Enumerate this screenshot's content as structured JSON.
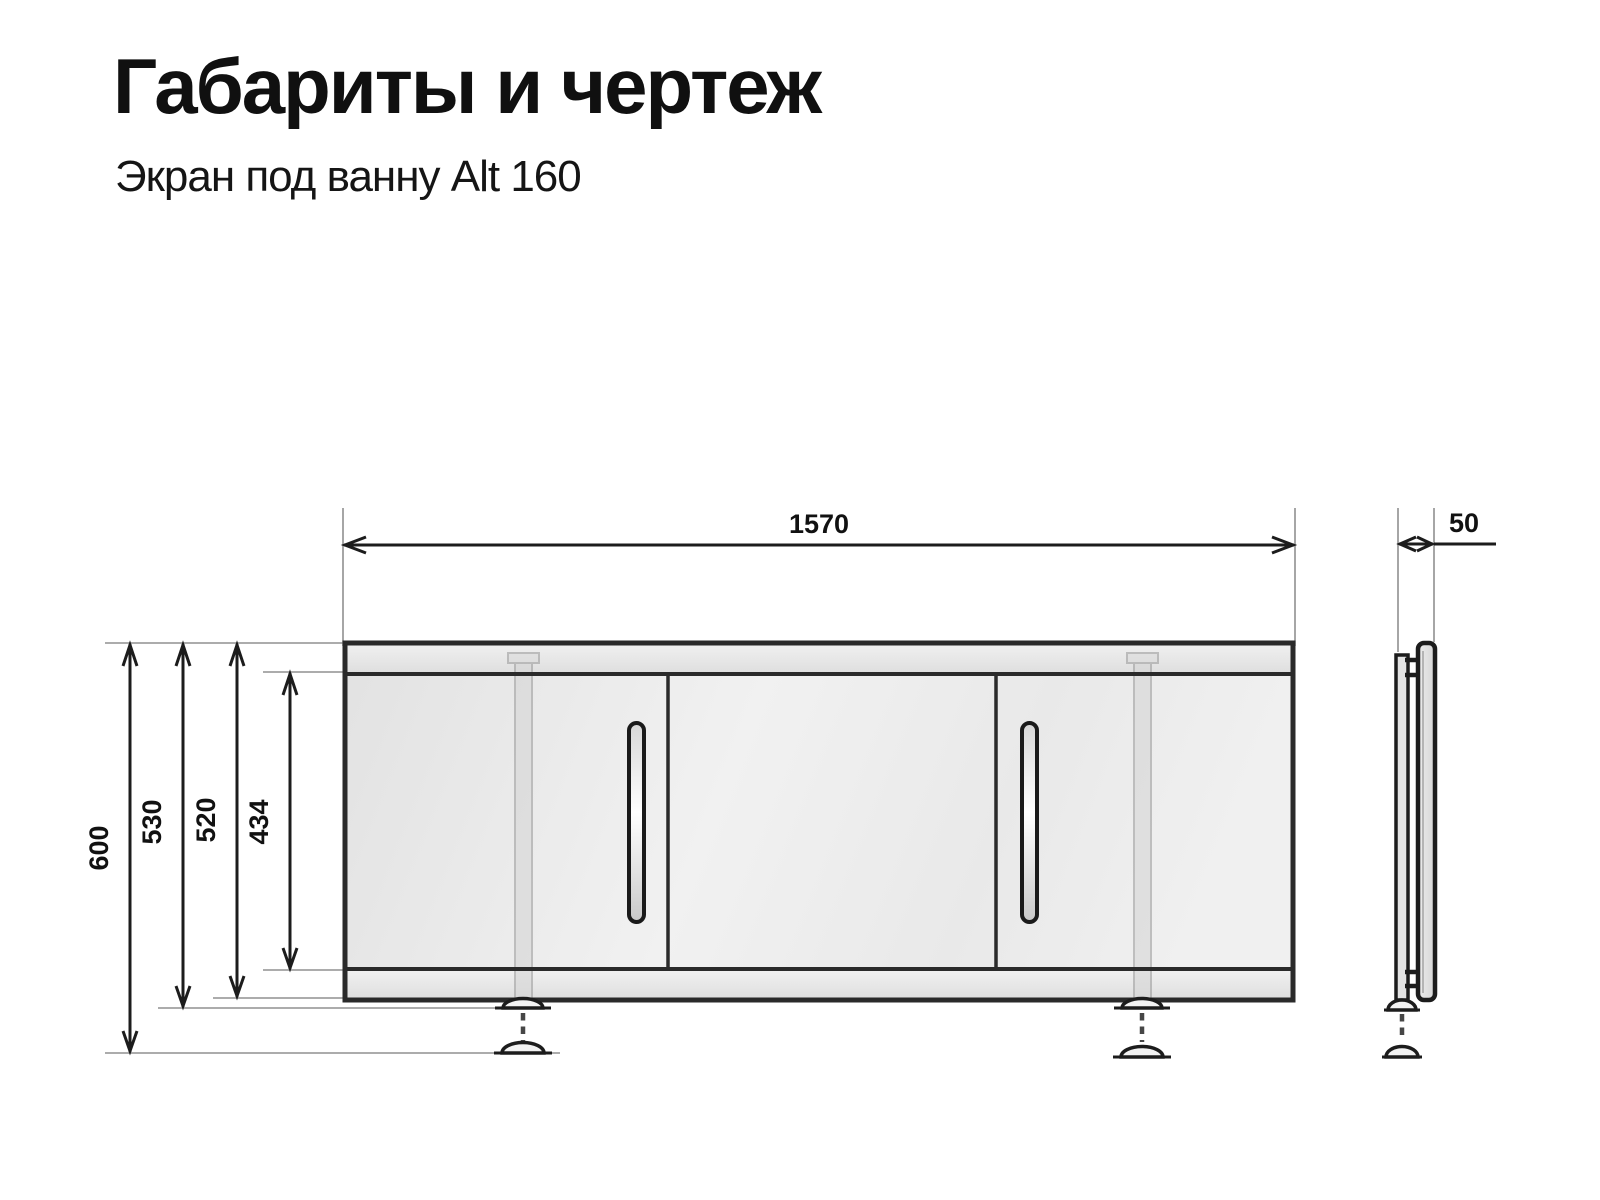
{
  "header": {
    "title": "Габариты и чертеж",
    "subtitle": "Экран под ванну Alt 160"
  },
  "dimensions": {
    "overall_width": "1570",
    "depth": "50",
    "height_overall": "600",
    "height_to_foot": "530",
    "height_body": "520",
    "height_panel": "434"
  },
  "drawing": {
    "views": [
      "front",
      "side"
    ],
    "panel_count": 3,
    "handle_count": 2,
    "leg_count": 2
  },
  "colors": {
    "background": "#ffffff",
    "text": "#111111",
    "outline_dark": "#2a2a2a",
    "dimension_line": "#1c1c1c",
    "extension_line": "#909090",
    "panel_fill": "#ebebeb",
    "leg_fill": "#cfcfcf"
  }
}
